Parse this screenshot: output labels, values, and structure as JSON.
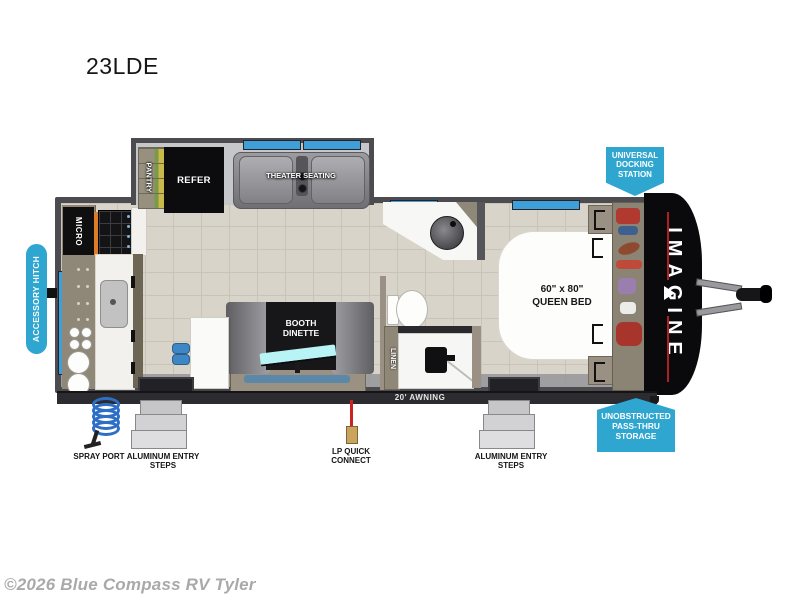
{
  "page": {
    "title": "23LDE",
    "copyright": "©2026 Blue Compass RV Tyler"
  },
  "callouts": {
    "accessory_hitch": "ACCESSORY HITCH",
    "universal_docking": "UNIVERSAL DOCKING STATION",
    "pass_thru_storage": "UNOBSTRUCTED PASS-THRU STORAGE"
  },
  "interior": {
    "pantry": "PANTRY",
    "refer": "REFER",
    "theater_seating": "THEATER SEATING",
    "micro": "MICRO",
    "booth_dinette": "BOOTH DINETTE",
    "linen": "LINEN",
    "bed_size": "60\" x 80\"",
    "bed_name": "QUEEN BED",
    "brand": "IMAGINE"
  },
  "exterior": {
    "awning": "20' AWNING",
    "spray_port": "SPRAY PORT",
    "aluminum_steps": "ALUMINUM ENTRY STEPS",
    "lp_quick_connect": "LP QUICK CONNECT"
  },
  "colors": {
    "callout_accent": "#2fa6d0",
    "window_blue": "#3f9fd9",
    "wall_gray": "#4b4b50",
    "floor_tile": "#d9d4c9",
    "brand_red_stripe": "#b01f24"
  }
}
